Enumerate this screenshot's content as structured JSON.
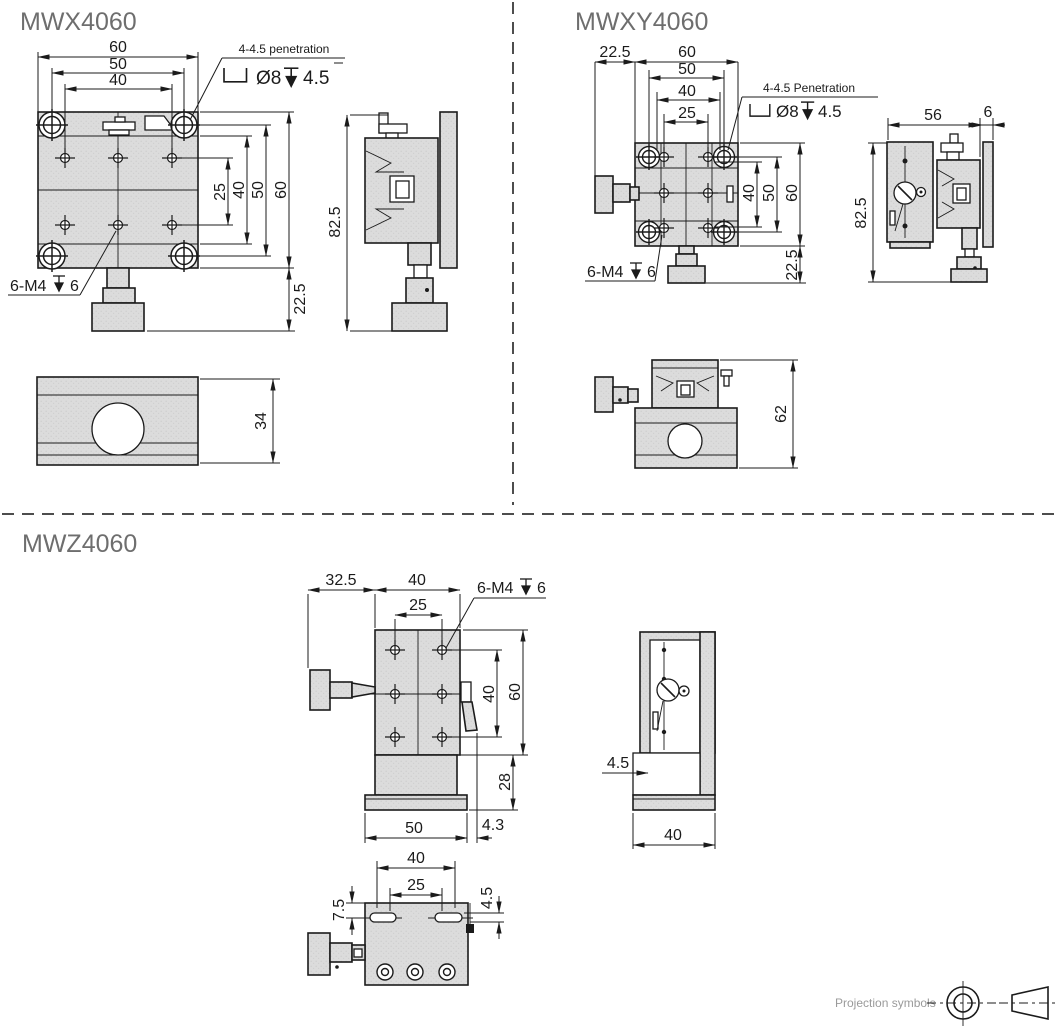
{
  "colors": {
    "part_fill": "#dcdcdc",
    "line": "#1b1b1b",
    "title_gray": "#6e6e6e",
    "muted_gray": "#9a9a9a"
  },
  "mwx": {
    "title": "MWX4060",
    "front": {
      "top_dims": [
        "60",
        "50",
        "40"
      ],
      "right_dims": [
        "25",
        "40",
        "50",
        "60"
      ],
      "bottom_right_dim": "22.5",
      "penetration_note": "4-4.5 penetration",
      "counterbore_dia": "Ø8",
      "counterbore_depth": "4.5",
      "tap_note": "6-M4",
      "tap_depth": "6"
    },
    "side": {
      "height_dim": "82.5"
    },
    "bottom": {
      "height_dim": "34"
    }
  },
  "mwxy": {
    "title": "MWXY4060",
    "front": {
      "left_dim": "22.5",
      "top_dims": [
        "60",
        "50",
        "40",
        "25"
      ],
      "right_dims": [
        "40",
        "50",
        "60"
      ],
      "bottom_right_dim": "22.5",
      "penetration_note": "4-4.5 Penetration",
      "counterbore_dia": "Ø8",
      "counterbore_depth": "4.5",
      "tap_note": "6-M4",
      "tap_depth": "6"
    },
    "side": {
      "width_dim": "56",
      "plate_dim": "6",
      "height_dim": "82.5"
    },
    "bottom": {
      "height_dim": "62"
    }
  },
  "mwz": {
    "title": "MWZ4060",
    "front": {
      "top_dims": [
        "32.5",
        "40",
        "25"
      ],
      "tap_note": "6-M4",
      "tap_depth": "6",
      "right_dims": [
        "40",
        "60"
      ],
      "base_height_dim": "28",
      "bottom_dims": [
        "50",
        "4.3"
      ]
    },
    "side": {
      "offset_dim": "4.5",
      "width_dim": "40"
    },
    "bottom": {
      "top_dims": [
        "40",
        "25"
      ],
      "left_dim": "7.5",
      "right_dim": "4.5"
    }
  },
  "footer": {
    "projection_label": "Projection symbols"
  }
}
